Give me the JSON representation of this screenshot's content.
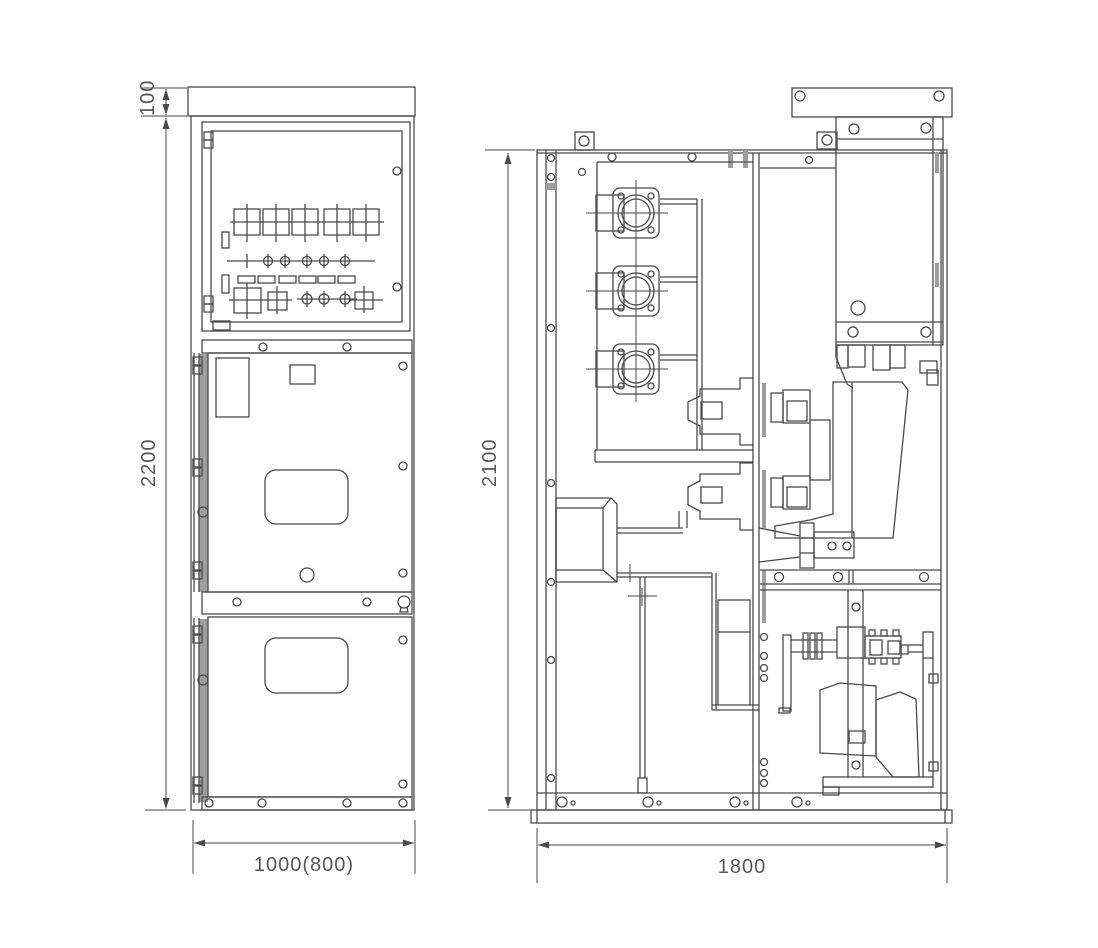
{
  "drawing": {
    "kind": "switchgear-cabinet-outline-drawing",
    "dimensions": {
      "top_cap_height": "100",
      "front_total_height": "2200",
      "front_width": "1000(800)",
      "side_height": "2100",
      "side_depth": "1800"
    },
    "colors": {
      "line": "#4a4a4a",
      "text": "#575757",
      "slot_fill": "#9e9e9e",
      "background": "#ffffff"
    }
  }
}
